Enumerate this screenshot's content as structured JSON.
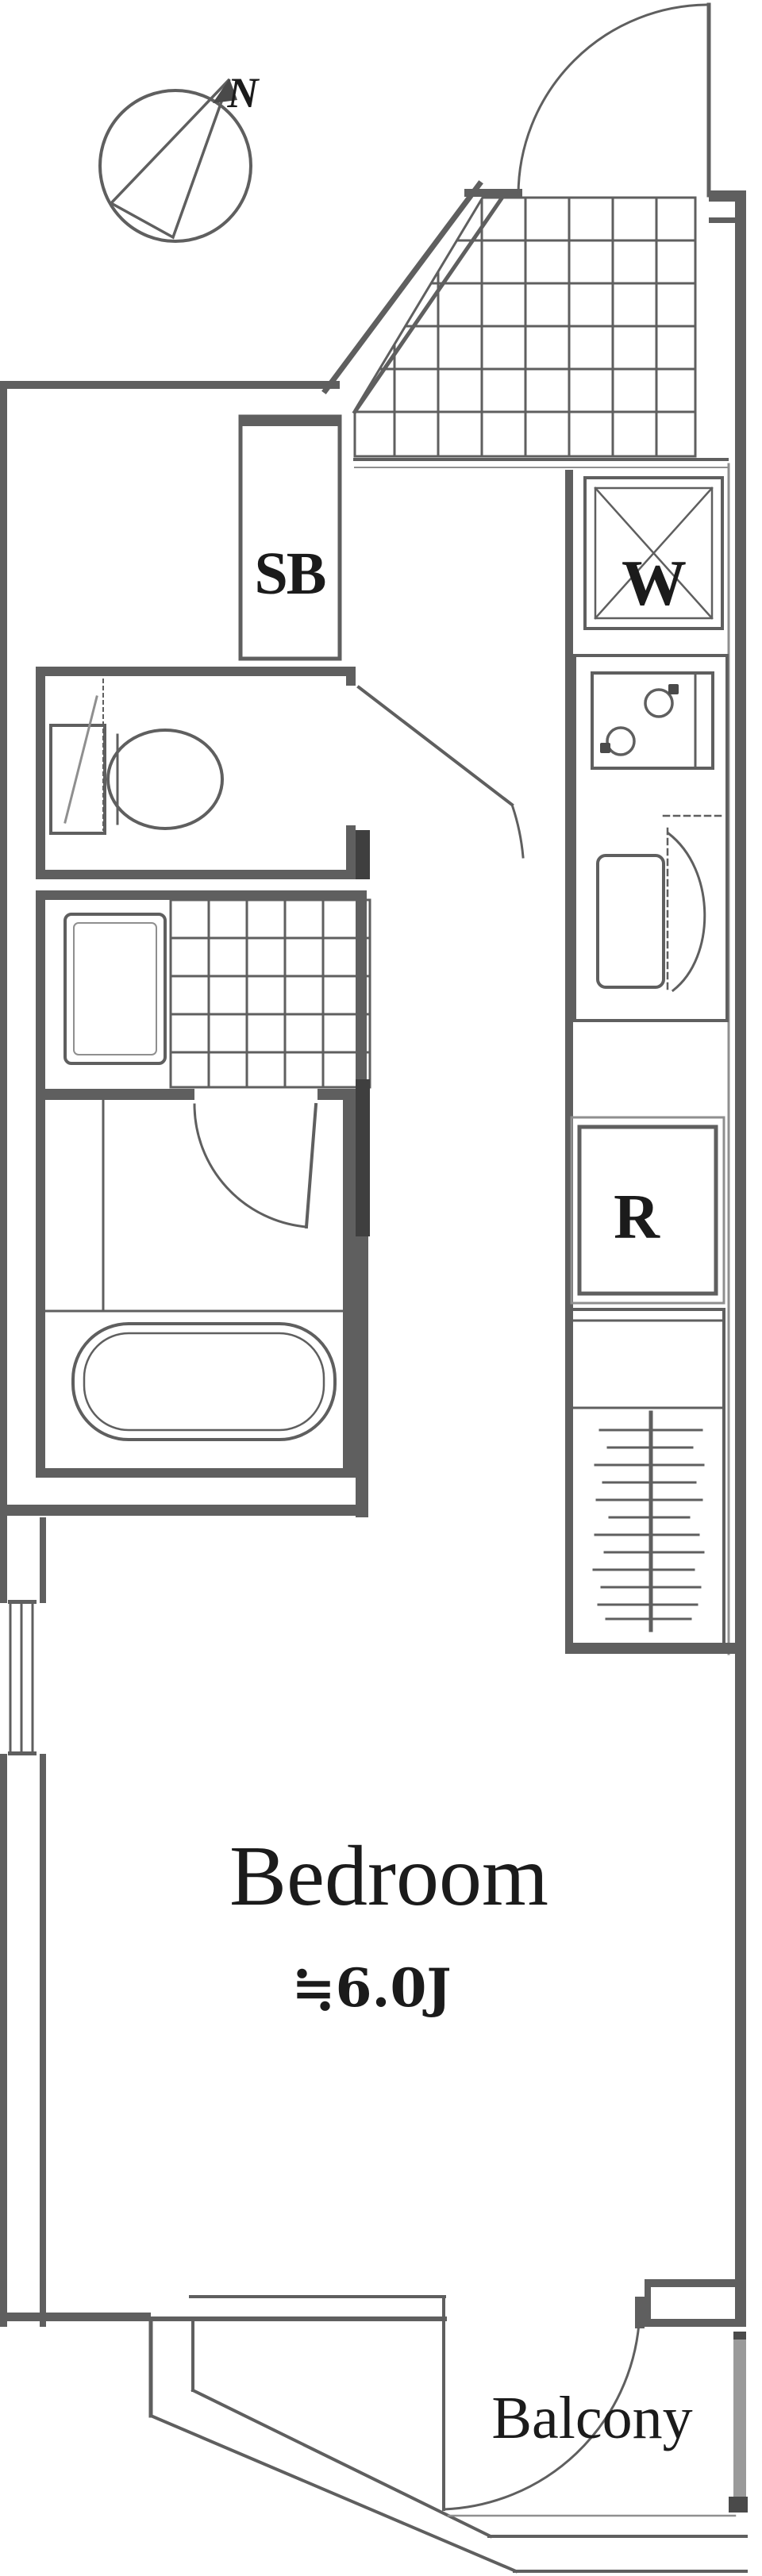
{
  "labels": {
    "north": "N",
    "shoe_box": "SB",
    "washing_machine": "W",
    "refrigerator": "R",
    "bedroom": "Bedroom",
    "bedroom_size": "≒6.0J",
    "balcony": "Balcony"
  },
  "colors": {
    "wall": "#5f5f5f",
    "dark_wall": "#3f3f3f",
    "label": "#1b1b1b",
    "background": "#ffffff"
  }
}
